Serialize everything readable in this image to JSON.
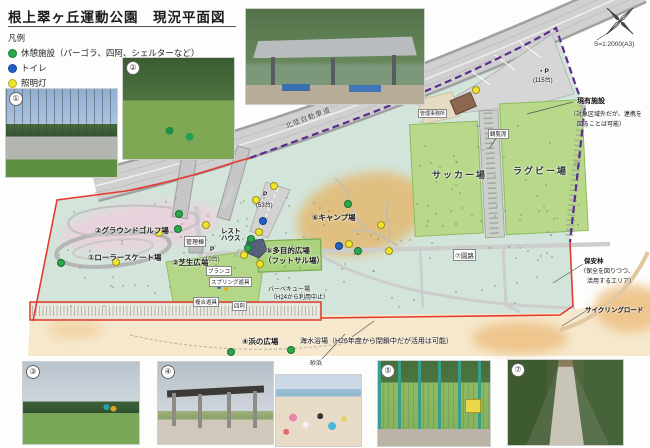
{
  "title": "根上翠ヶ丘運動公園　現況平面図",
  "legend": {
    "heading": "凡例",
    "items": [
      {
        "label": "休憩施設（パーゴラ、四阿、シェルターなど）",
        "color": "#2ba84a"
      },
      {
        "label": "トイレ",
        "color": "#2060c8"
      },
      {
        "label": "照明灯",
        "color": "#f0e32c"
      }
    ]
  },
  "compass": {
    "scale": "S=1:2000(A3)"
  },
  "map": {
    "expressway": "北陸自動車道",
    "roller": "①ローラースケート場",
    "golf": "②グラウンドゴルフ場",
    "lawn": "③芝生広場",
    "beach_plaza": "④浜の広場",
    "multi1": "⑤多目的広場",
    "multi2": "（フットサル場）",
    "camp": "⑥キャンプ場",
    "path7": "⑦園路",
    "mgmt_bldg": "管理棟",
    "rest_house": "レストハウス",
    "p10": "P",
    "p10_n": "(10台)",
    "p53": "P",
    "p53_n": "(53台)",
    "p115": "・P",
    "p115_n": "(115台)",
    "soccer": "サッカー場",
    "rugby": "ラグビー場",
    "stand": "観覧席",
    "office": "管理事務所",
    "existing1": "現有施設",
    "existing2": "（対象区域外だが、連携を",
    "existing3": "図ることは可能）",
    "forest1": "保安林",
    "forest2": "（保全を図りつつ、",
    "forest3": "活用するエリア）",
    "cycling": "サイクリングロード",
    "swing": "ブランコ",
    "spring": "スプリング遊具",
    "combo": "複合遊具",
    "azumaya": "四阿",
    "bbq1": "バーベキュー場",
    "bbq2": "（H24から利用中止）",
    "beach_note": "海水浴場（H26年度から閉鎖中だが活用は可能）",
    "sand": "砂浜"
  },
  "photos": {
    "p1_badge": "①",
    "p2_badge": "②",
    "p3_badge": "③",
    "p4_badge": "④",
    "p5_badge": "⑤",
    "p7_badge": "⑦"
  },
  "markers": [
    {
      "x": 475,
      "y": 89,
      "t": "y"
    },
    {
      "x": 273,
      "y": 185,
      "t": "y"
    },
    {
      "x": 255,
      "y": 199,
      "t": "y"
    },
    {
      "x": 258,
      "y": 231,
      "t": "y"
    },
    {
      "x": 243,
      "y": 254,
      "t": "y"
    },
    {
      "x": 259,
      "y": 263,
      "t": "y"
    },
    {
      "x": 205,
      "y": 224,
      "t": "y"
    },
    {
      "x": 158,
      "y": 232,
      "t": "y"
    },
    {
      "x": 115,
      "y": 261,
      "t": "y"
    },
    {
      "x": 348,
      "y": 243,
      "t": "y"
    },
    {
      "x": 380,
      "y": 224,
      "t": "y"
    },
    {
      "x": 388,
      "y": 250,
      "t": "y"
    },
    {
      "x": 262,
      "y": 220,
      "t": "b"
    },
    {
      "x": 338,
      "y": 245,
      "t": "b"
    },
    {
      "x": 347,
      "y": 203,
      "t": "g"
    },
    {
      "x": 250,
      "y": 238,
      "t": "g"
    },
    {
      "x": 247,
      "y": 247,
      "t": "g"
    },
    {
      "x": 178,
      "y": 213,
      "t": "g"
    },
    {
      "x": 177,
      "y": 228,
      "t": "g"
    },
    {
      "x": 60,
      "y": 262,
      "t": "g"
    },
    {
      "x": 357,
      "y": 250,
      "t": "g"
    },
    {
      "x": 230,
      "y": 351,
      "t": "g"
    },
    {
      "x": 290,
      "y": 349,
      "t": "g"
    }
  ],
  "colors": {
    "boundary_red": "#e23b30",
    "boundary_purple": "#5b2d8e",
    "park_base": "#d3e4da",
    "field_green": "#b7d989",
    "camp_orange": "#e7af59",
    "golf_pink": "#ecd0de",
    "sand": "#f6e8cc"
  }
}
